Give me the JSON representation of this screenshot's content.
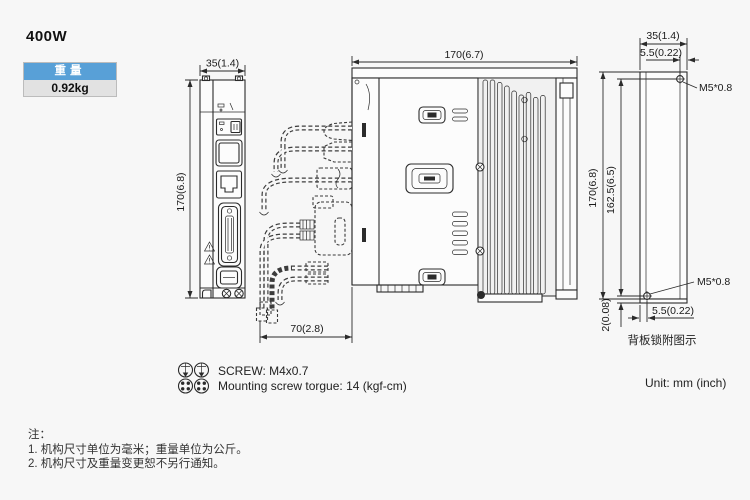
{
  "page": {
    "title": "400W",
    "unit_label": "Unit: mm (inch)",
    "background": "#f7f7f7",
    "line_color": "#2b2b2b"
  },
  "weight_badge": {
    "header": "重量",
    "value": "0.92kg",
    "header_bg": "#58a0d7",
    "header_text_color": "#ffffff",
    "value_bg": "#e2e2e2"
  },
  "views": {
    "front": {
      "width_dim": "35(1.4)",
      "height_dim": "170(6.8)"
    },
    "side": {
      "width_dim": "170(6.7)",
      "cable_clearance_dim": "70(2.8)"
    },
    "back": {
      "width_dim": "35(1.4)",
      "top_screw_offset_dim": "5.5(0.22)",
      "top_screw_label": "M5*0.8",
      "height_dim": "170(6.8)",
      "mount_hole_span_dim": "162.5(6.5)",
      "bottom_screw_label": "M5*0.8",
      "bottom_screw_offset_dim": "5.5(0.22)",
      "back_lip_dim": "2(0.08)",
      "caption": "背板锁附图示"
    }
  },
  "screw_note": {
    "line1": "SCREW: M4x0.7",
    "line2": "Mounting screw torgue: 14 (kgf-cm)"
  },
  "notes": {
    "header": "注：",
    "items": [
      "1. 机构尺寸单位为毫米；重量单位为公斤。",
      "2. 机构尺寸及重量变更恕不另行通知。"
    ]
  }
}
